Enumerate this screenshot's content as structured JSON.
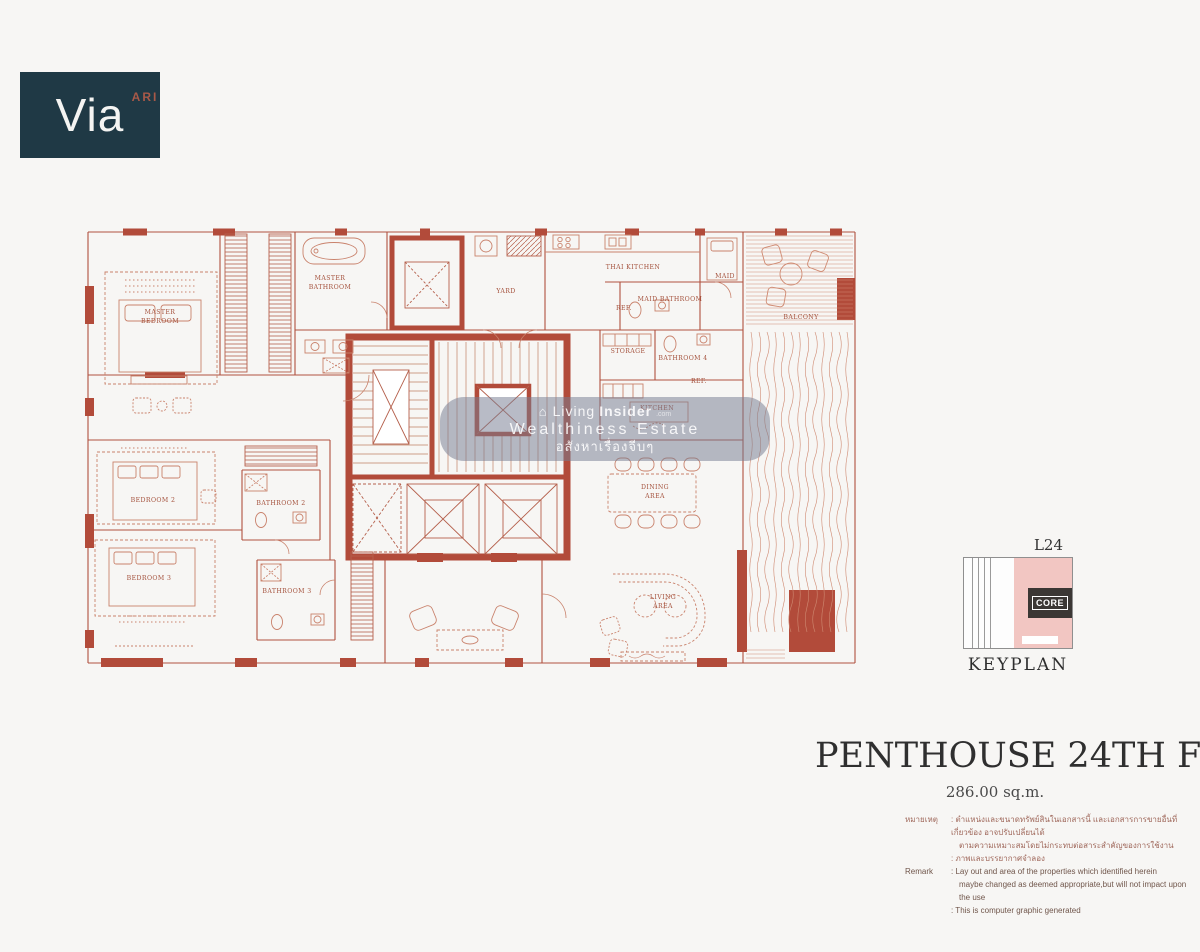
{
  "logo": {
    "brand": "Via",
    "suffix": "ARI"
  },
  "plan": {
    "accent": "#b0503e",
    "room_labels": [
      {
        "lines": [
          "MASTER",
          "BEDROOM"
        ],
        "x": 75,
        "y": 92
      },
      {
        "lines": [
          "MASTER",
          "BATHROOM"
        ],
        "x": 245,
        "y": 58
      },
      {
        "lines": [
          "YARD"
        ],
        "x": 421,
        "y": 71
      },
      {
        "lines": [
          "THAI KITCHEN"
        ],
        "x": 548,
        "y": 47
      },
      {
        "lines": [
          "MAID"
        ],
        "x": 640,
        "y": 56
      },
      {
        "lines": [
          "MAID BATHROOM"
        ],
        "x": 585,
        "y": 79
      },
      {
        "lines": [
          "REF."
        ],
        "x": 539,
        "y": 88
      },
      {
        "lines": [
          "STORAGE"
        ],
        "x": 543,
        "y": 131
      },
      {
        "lines": [
          "BATHROOM 4"
        ],
        "x": 598,
        "y": 138
      },
      {
        "lines": [
          "REF."
        ],
        "x": 614,
        "y": 161
      },
      {
        "lines": [
          "KITCHEN"
        ],
        "x": 572,
        "y": 188
      },
      {
        "lines": [
          "BALCONY"
        ],
        "x": 716,
        "y": 97
      },
      {
        "lines": [
          "DINING",
          "AREA"
        ],
        "x": 570,
        "y": 267
      },
      {
        "lines": [
          "LIVING",
          "AREA"
        ],
        "x": 578,
        "y": 377
      },
      {
        "lines": [
          "BEDROOM 2"
        ],
        "x": 68,
        "y": 280
      },
      {
        "lines": [
          "BATHROOM 2"
        ],
        "x": 196,
        "y": 283
      },
      {
        "lines": [
          "BEDROOM 3"
        ],
        "x": 64,
        "y": 358
      },
      {
        "lines": [
          "BATHROOM 3"
        ],
        "x": 202,
        "y": 371
      }
    ]
  },
  "watermark": {
    "brand_light": "Living",
    "brand_bold": "Insider",
    "brand_tld": ".com",
    "line2": "Wealthiness Estate",
    "line3": "อสังหาเรื่องจีบๆ"
  },
  "keyplan": {
    "floor": "L24",
    "core": "CORE",
    "caption": "KEYPLAN"
  },
  "titleblock": {
    "heading": "PENTHOUSE 24TH FL.",
    "area": "286.00 sq.m."
  },
  "remarks": {
    "thai_label": "หมายเหตุ",
    "thai_line1": ": ตำแหน่งและขนาดทรัพย์สินในเอกสารนี้ และเอกสารการขายอื่นที่เกี่ยวข้อง อาจปรับเปลี่ยนได้",
    "thai_line2": "ตามความเหมาะสมโดยไม่กระทบต่อสาระสำคัญของการใช้งาน",
    "thai_line3": ": ภาพและบรรยากาศจำลอง",
    "en_label": "Remark",
    "en_line1": ": Lay out and area of the properties which identified herein",
    "en_line2": "maybe changed as deemed appropriate,but will not impact upon the use",
    "en_line3": ": This is computer graphic generated"
  }
}
